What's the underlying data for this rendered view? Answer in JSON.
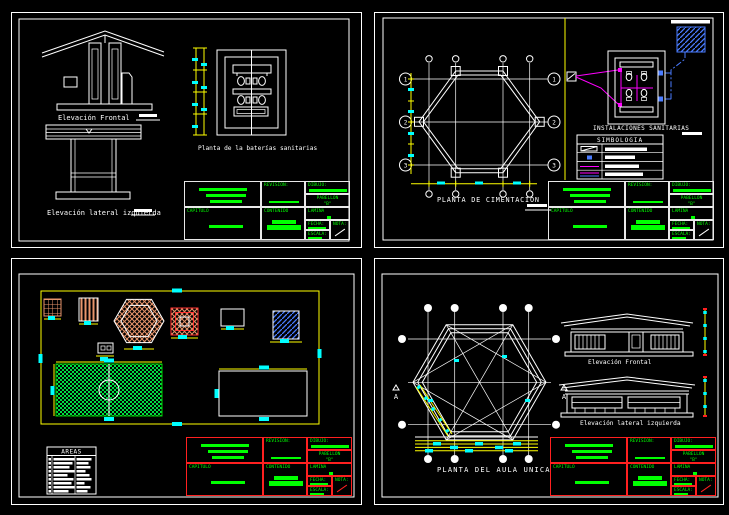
{
  "window": {
    "description": "CAD drawing set, four sheets on black background"
  },
  "colors": {
    "background": "#000000",
    "line_white": "#ffffff",
    "annotation_green": "#00ff00",
    "dimension_yellow": "#ffff00",
    "dimension_cyan": "#00ffff",
    "pipe_magenta": "#ff00ff",
    "pipe_blue": "#4a7cff",
    "hatch_orange": "#e8956b",
    "titleblock_red": "#ff2020",
    "field_green": "#00dd44"
  },
  "titleblock": {
    "revision_label": "REVISION:",
    "capitulo_label": "CAPITULO",
    "contenido_label": "CONTENIDO",
    "dibujo_label": "DIBUJO:",
    "pabellon_label": "PABELLON",
    "pabellon_value": "\"B\"",
    "lamina_label": "LAMINA",
    "fecha_label": "FECHA:",
    "nota_label": "NOTA:",
    "escala_label": "ESCALA:"
  },
  "sheet_sanitary": {
    "elevacion_frontal": "Elevación Frontal",
    "elevacion_lateral": "Elevación lateral izquierda",
    "planta_baterias": "Planta de la baterías sanitarias"
  },
  "sheet_cimentacion": {
    "planta": "PLANTA DE CIMENTACION",
    "instalaciones": "INSTALACIONES SANITARIAS",
    "simbologia": "SIMBOLOGIA",
    "grid_rows": [
      "1",
      "2",
      "3"
    ]
  },
  "sheet_sitio": {
    "areas": "AREAS"
  },
  "sheet_aula": {
    "planta": "PLANTA DEL AULA UNICA",
    "elevacion_frontal": "Elevación Frontal",
    "elevacion_lateral": "Elevación lateral izquierda",
    "section": "A"
  }
}
